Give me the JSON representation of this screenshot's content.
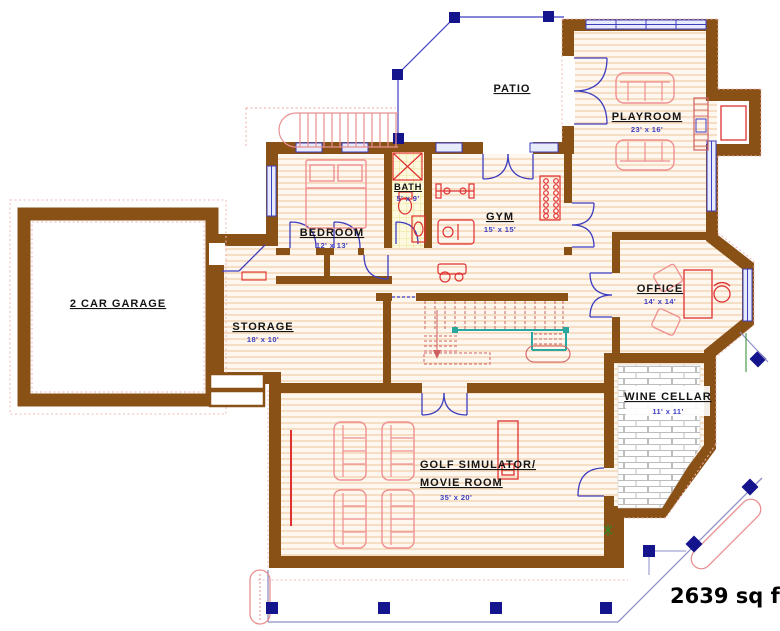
{
  "plan": {
    "rooms": {
      "garage": {
        "name": "2 CAR GARAGE"
      },
      "storage": {
        "name": "STORAGE",
        "dim": "18' x 10'"
      },
      "bedroom": {
        "name": "BEDROOM",
        "dim": "12' x 13'"
      },
      "bath": {
        "name": "BATH",
        "dim": "5' x 9'"
      },
      "gym": {
        "name": "GYM",
        "dim": "15' x 15'"
      },
      "patio": {
        "name": "PATIO"
      },
      "playroom": {
        "name": "PLAYROOM",
        "dim": "23' x 16'"
      },
      "office": {
        "name": "OFFICE",
        "dim": "14' x 14'"
      },
      "wine_cellar": {
        "name": "WINE CELLAR",
        "dim": "11' x 11'"
      },
      "golf_movie": {
        "name_line1": "GOLF SIMULATOR/",
        "name_line2": "MOVIE ROOM",
        "dim": "35' x 20'"
      }
    },
    "total_area": "2639 sq ft",
    "colors": {
      "wall_brown": "#8a5117",
      "floor_hatch": "#f2c9a2",
      "furniture_pink": "#ef8f8f",
      "fixture_red": "#e03030",
      "door_window_blue": "#3e3ec0",
      "post_navy": "#14148c",
      "stair_rail_teal": "#2aa6a0",
      "dimension_text_blue": "#3e3ec0",
      "exterior_dash_pink": "#f2b8b8"
    }
  }
}
